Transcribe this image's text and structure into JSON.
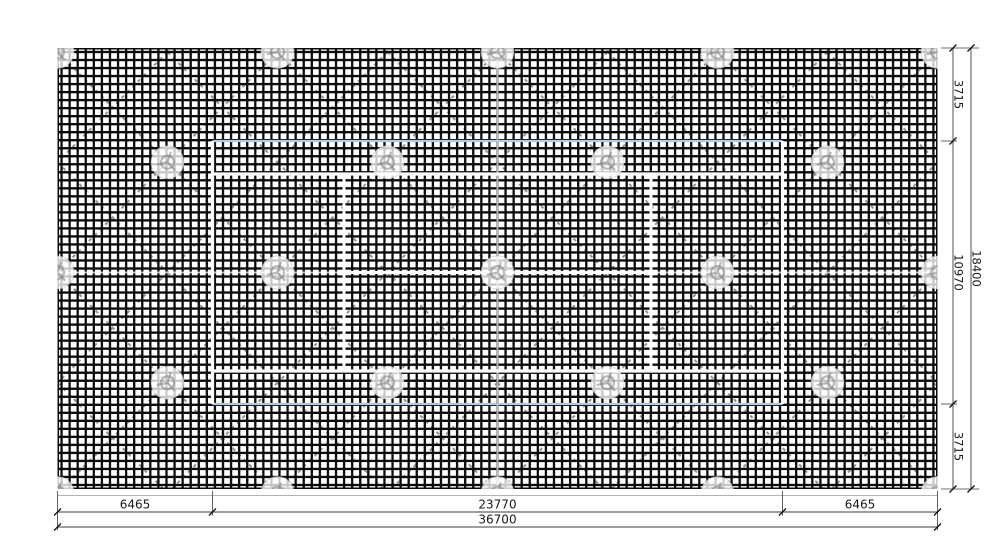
{
  "drawing": {
    "description": "Tennis court site plan: fenced mesh area with tree symbols, diagonal bracing lattice and dimension lines",
    "units": "mm",
    "dimensions": {
      "bottom": {
        "left": "6465",
        "center": "23770",
        "right": "6465",
        "total": "36700"
      },
      "right": {
        "top": "3715",
        "middle": "10970",
        "bottom": "3715",
        "total": "18400"
      }
    },
    "colors": {
      "background": "#ffffff",
      "mesh": "#0b0b0b",
      "court_line": "#ffffff",
      "court_boundary_blue": "#b4c8e6",
      "diagonal_brace": "#8f8f8f",
      "tree_symbol": "#9b9b9b",
      "dimension_line": "#3c3c3c",
      "dimension_text": "#1a1a1a"
    }
  }
}
